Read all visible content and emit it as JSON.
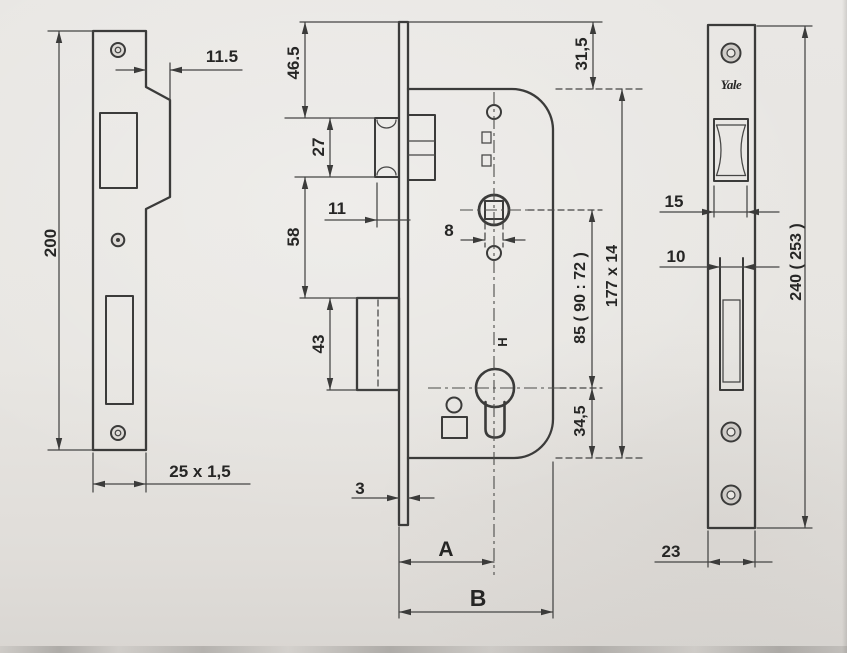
{
  "colors": {
    "paper": "#e8e6e2",
    "ink": "#3b3b3a"
  },
  "views": {
    "strike_plate": {
      "dims": {
        "lip_offset": "11.5",
        "height": "200",
        "profile": "25 x 1,5"
      }
    },
    "lock_case": {
      "dims": {
        "top_to_latch": "46.5",
        "latch_height": "27",
        "latch_to_deadbolt": "58",
        "deadbolt_height": "43",
        "latch_projection": "11",
        "spindle_square": "8",
        "top_margin": "31,5",
        "centre_distance": "85 ( 90 : 72 )",
        "case_size": "177 x 14",
        "cylinder_to_bottom": "34,5",
        "faceplate_thickness": "3",
        "backset": "A",
        "overall_depth": "B",
        "stamp": "H"
      }
    },
    "face_plate": {
      "brand": "Yale",
      "dims": {
        "latch_width": "15",
        "deadbolt_width": "10",
        "plate_width": "23",
        "plate_length": "240 ( 253 )"
      }
    }
  }
}
